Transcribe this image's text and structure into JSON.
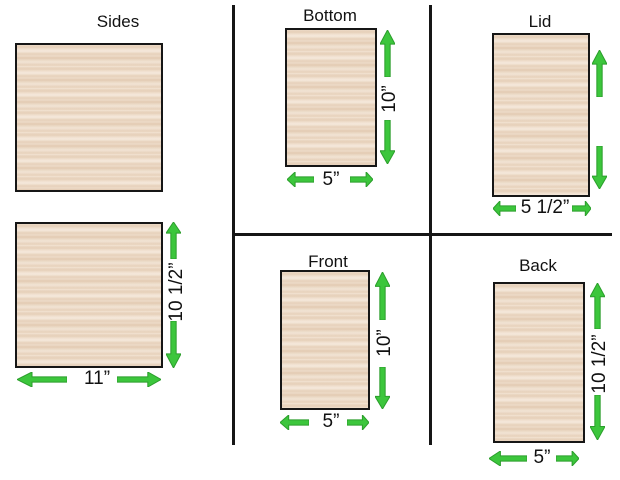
{
  "colors": {
    "background": "#ffffff",
    "wood_base": "#f3e4d4",
    "panel_border": "#161616",
    "divider": "#161616",
    "arrow_fill": "#3cc63c",
    "arrow_stroke": "#2b9e2b",
    "text": "#111111"
  },
  "icons": {
    "dimension_arrow": "green-block-arrow"
  },
  "panels": {
    "sides": {
      "label": "Sides",
      "height_label": "10 1/2”",
      "width_label": "11”"
    },
    "bottom": {
      "label": "Bottom",
      "height_label": "10”",
      "width_label": "5”"
    },
    "lid": {
      "label": "Lid",
      "width_label": "5 1/2”"
    },
    "front": {
      "label": "Front",
      "height_label": "10”",
      "width_label": "5”"
    },
    "back": {
      "label": "Back",
      "height_label": "10 1/2”",
      "width_label": "5”"
    }
  }
}
